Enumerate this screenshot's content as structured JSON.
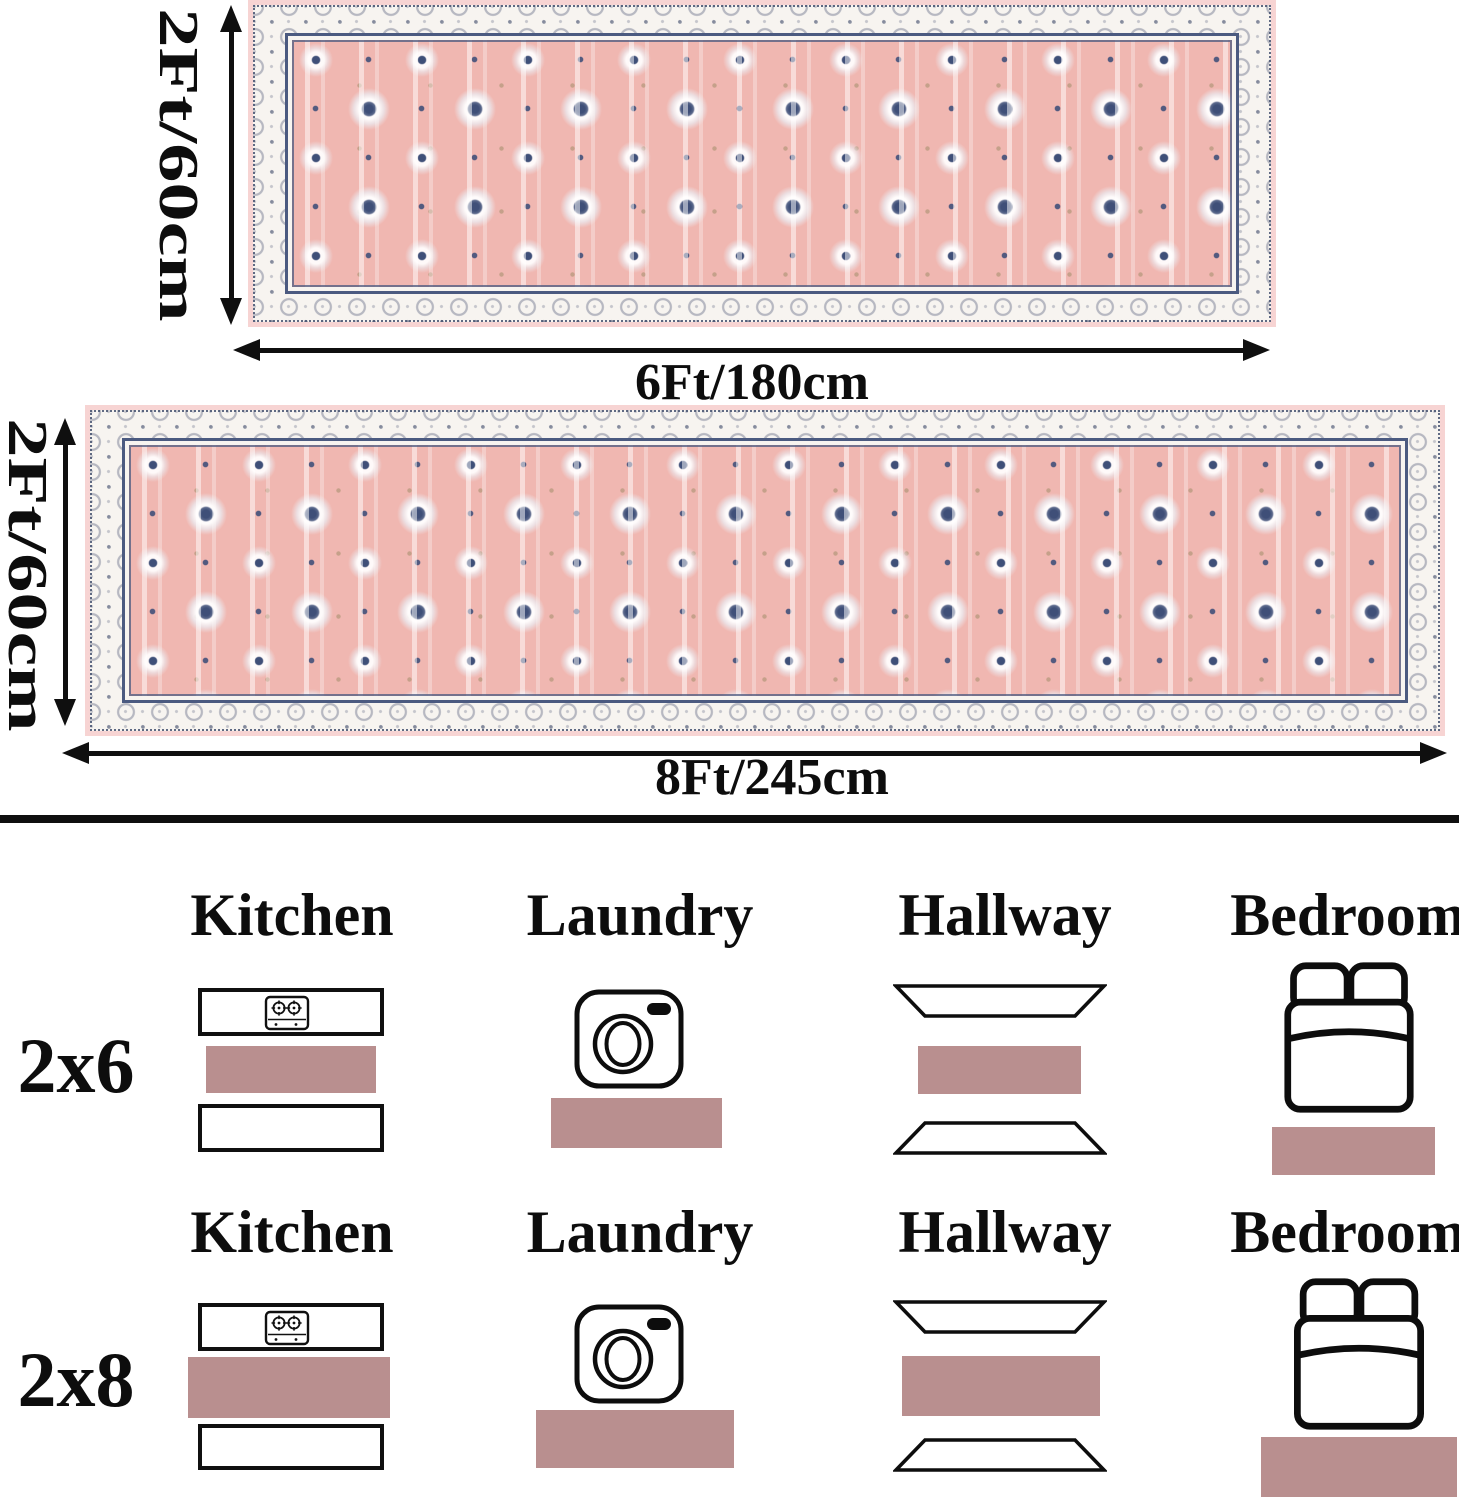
{
  "dimension_diagram": {
    "rug_2x6": {
      "height_label": "2Ft/60cm",
      "width_label": "6Ft/180cm"
    },
    "rug_2x8": {
      "height_label": "2Ft/60cm",
      "width_label": "8Ft/245cm"
    }
  },
  "placement_guide": {
    "rows": [
      {
        "size": "2x6",
        "rooms": [
          {
            "name": "Kitchen"
          },
          {
            "name": "Laundry"
          },
          {
            "name": "Hallway"
          },
          {
            "name": "Bedroom"
          }
        ]
      },
      {
        "size": "2x8",
        "rooms": [
          {
            "name": "Kitchen"
          },
          {
            "name": "Laundry"
          },
          {
            "name": "Hallway"
          },
          {
            "name": "Bedroom"
          }
        ]
      }
    ]
  },
  "icons": {
    "kitchen": "stove-counter-icon",
    "laundry": "washing-machine-icon",
    "hallway": "hallway-floor-icon",
    "bedroom": "bed-icon",
    "dimensions": "double-arrow-icon"
  },
  "colors": {
    "rug_swatch": "#b98f8f",
    "rug_field_pink": "#f0b7b1",
    "rug_edge_pink": "#f7d4d3",
    "rug_border_ivory": "#f7f4f0",
    "pattern_navy": "#3f4f78",
    "line_black": "#0f0f0f"
  }
}
